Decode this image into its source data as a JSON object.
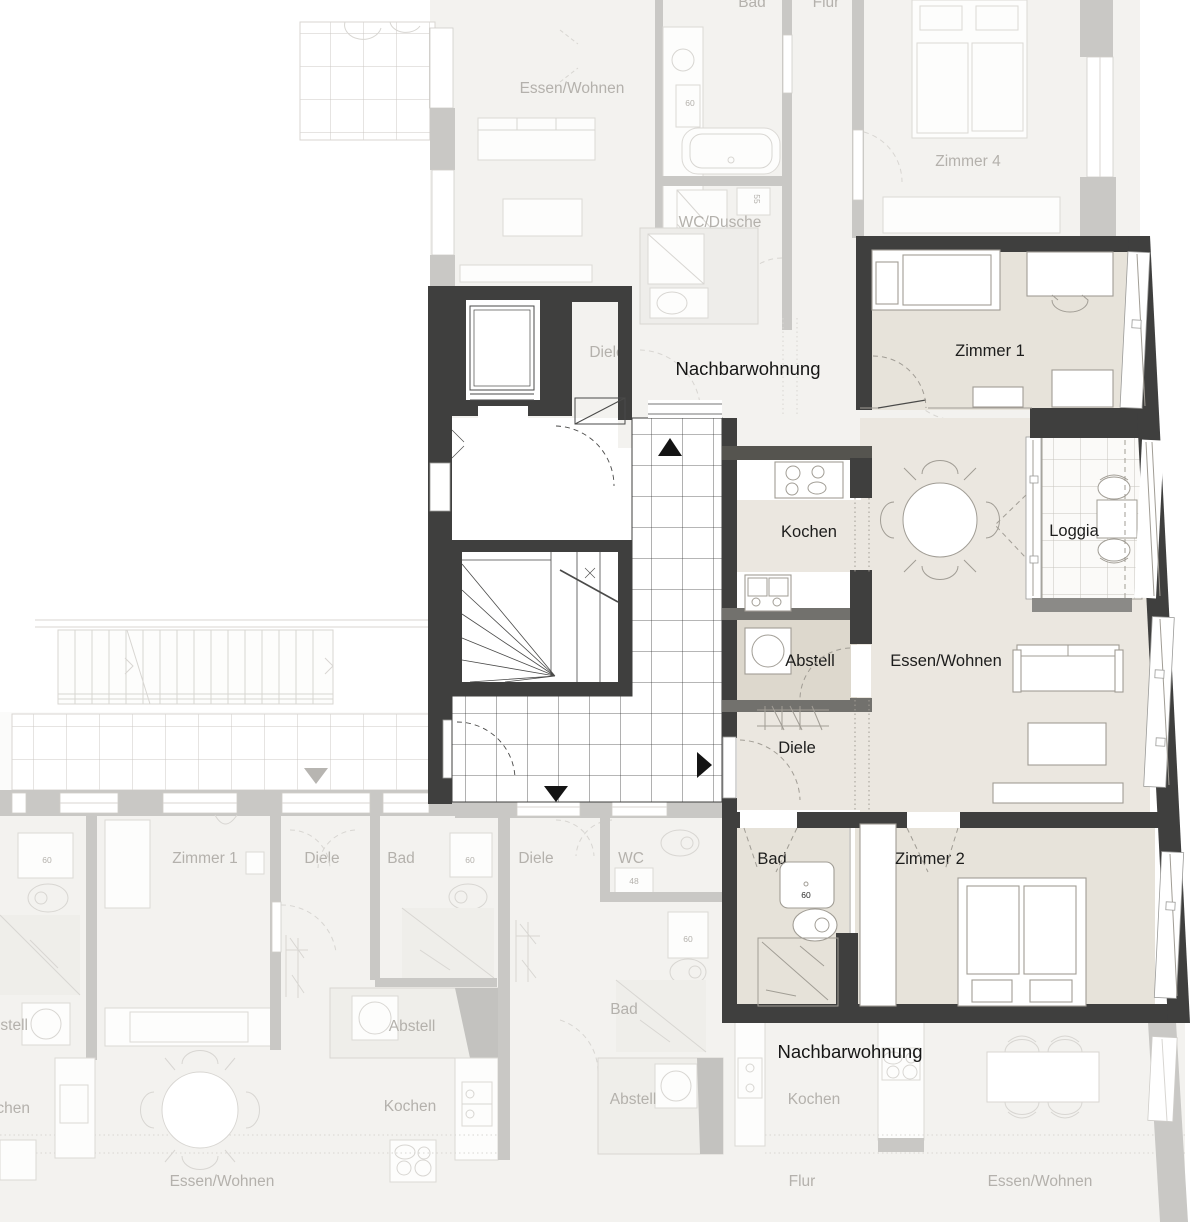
{
  "title": "Wohnungs-Grundriss",
  "colors": {
    "wall_dark": "#3f3f3e",
    "wall_faded": "#c9c8c5",
    "floor_highlight": "#ebe7e0",
    "floor_faded": "#f3f2ef",
    "label_dark": "#1d1d1c",
    "label_faded": "#b4b1ac"
  },
  "labels": {
    "apartment": {
      "zimmer1": "Zimmer 1",
      "zimmer2": "Zimmer 2",
      "kochen": "Kochen",
      "essen_wohnen": "Essen/Wohnen",
      "loggia": "Loggia",
      "abstell": "Abstell",
      "diele": "Diele",
      "bad": "Bad",
      "dim60": "60"
    },
    "neighbor": {
      "nachbarwohnung": "Nachbarwohnung",
      "essen_wohnen": "Essen/Wohnen",
      "zimmer1": "Zimmer 1",
      "zimmer4": "Zimmer 4",
      "wc_dusche": "WC/Dusche",
      "wc": "WC",
      "bad": "Bad",
      "flur": "Flur",
      "diele": "Diele",
      "kochen": "Kochen",
      "abstell": "Abstell",
      "dim60": "60",
      "dim55": "55",
      "dim48": "48"
    }
  }
}
